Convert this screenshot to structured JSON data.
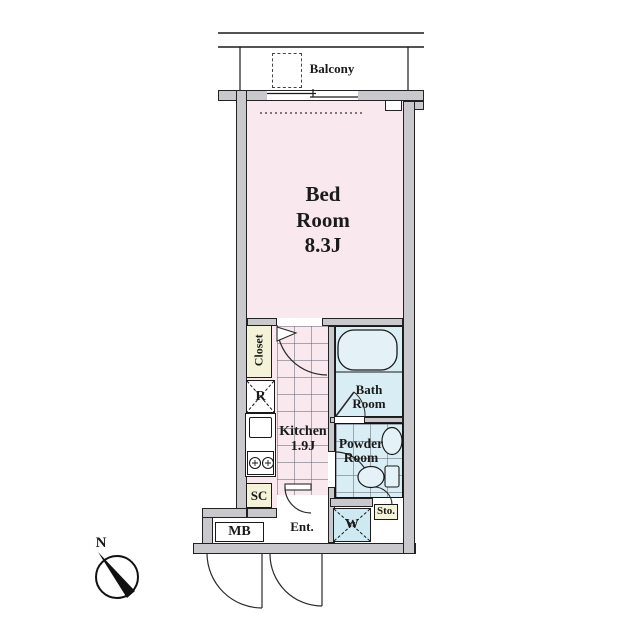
{
  "balcony": {
    "label": "Balcony"
  },
  "rooms": {
    "bedroom": {
      "line1": "Bed",
      "line2": "Room",
      "size": "8.3J"
    },
    "kitchen": {
      "label": "Kitchen",
      "size": "1.9J"
    },
    "bathroom": {
      "line1": "Bath",
      "line2": "Room"
    },
    "powder_room": {
      "line1": "Powder",
      "line2": "Room"
    },
    "entrance": {
      "label": "Ent."
    }
  },
  "storage": {
    "closet": "Closet",
    "shoe_closet": "SC",
    "storage": "Sto."
  },
  "fixtures": {
    "refrigerator": "R",
    "washer": "W",
    "meter_box": "MB"
  },
  "compass": {
    "north": "N"
  },
  "colors": {
    "wall_fill": "#c9c9cd",
    "room_pink": "#f9e9ee",
    "wet_area_blue": "#d9edf4",
    "closet_cream": "#f5f2da",
    "outline": "#1a1a1a"
  }
}
